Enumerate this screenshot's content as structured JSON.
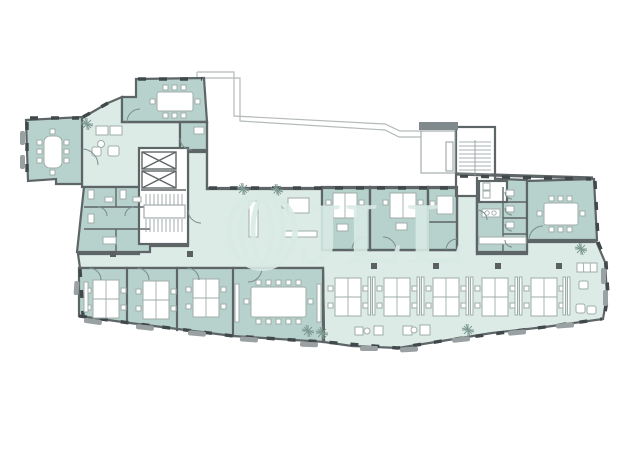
{
  "watermark": {
    "text": "JLL"
  },
  "palette": {
    "background": "#ffffff",
    "open": "#dcebe6",
    "room": "#b7d2cc",
    "wall": "#5e6567",
    "line": "#9aa6a4",
    "furniture_stroke": "#9fadaa",
    "window": "#41484b",
    "sill": "#9aa1a3",
    "column": "#5a6062",
    "plant": "#7f9a92",
    "watermark": "#d9eae5",
    "roof": "#b4bab9"
  },
  "floorplan": {
    "spaces": [
      {
        "name": "meeting-room-top-left",
        "type": "meeting",
        "seats": 8
      },
      {
        "name": "meeting-room-top",
        "type": "meeting",
        "seats": 8
      },
      {
        "name": "lounge",
        "type": "lounge"
      },
      {
        "name": "elevator-stair-core",
        "type": "core",
        "elevators": 2
      },
      {
        "name": "wc-left",
        "type": "sanitary"
      },
      {
        "name": "pantry-open-area",
        "type": "open"
      },
      {
        "name": "office-1",
        "type": "office",
        "desks": 2
      },
      {
        "name": "office-2",
        "type": "office",
        "desks": 2
      },
      {
        "name": "office-3",
        "type": "office",
        "desks": 1
      },
      {
        "name": "kitchen",
        "type": "kitchen"
      },
      {
        "name": "wc-right",
        "type": "sanitary",
        "stalls": 4
      },
      {
        "name": "stairwell-top-right",
        "type": "core"
      },
      {
        "name": "meeting-room-right",
        "type": "meeting",
        "seats": 8
      },
      {
        "name": "team-office-1",
        "type": "office",
        "desks": 4
      },
      {
        "name": "team-office-2",
        "type": "office",
        "desks": 4
      },
      {
        "name": "team-office-3",
        "type": "office",
        "desks": 4
      },
      {
        "name": "conference-room",
        "type": "meeting",
        "seats": 12
      },
      {
        "name": "open-office",
        "type": "open",
        "desk_clusters": 5,
        "desks": 20
      }
    ]
  }
}
